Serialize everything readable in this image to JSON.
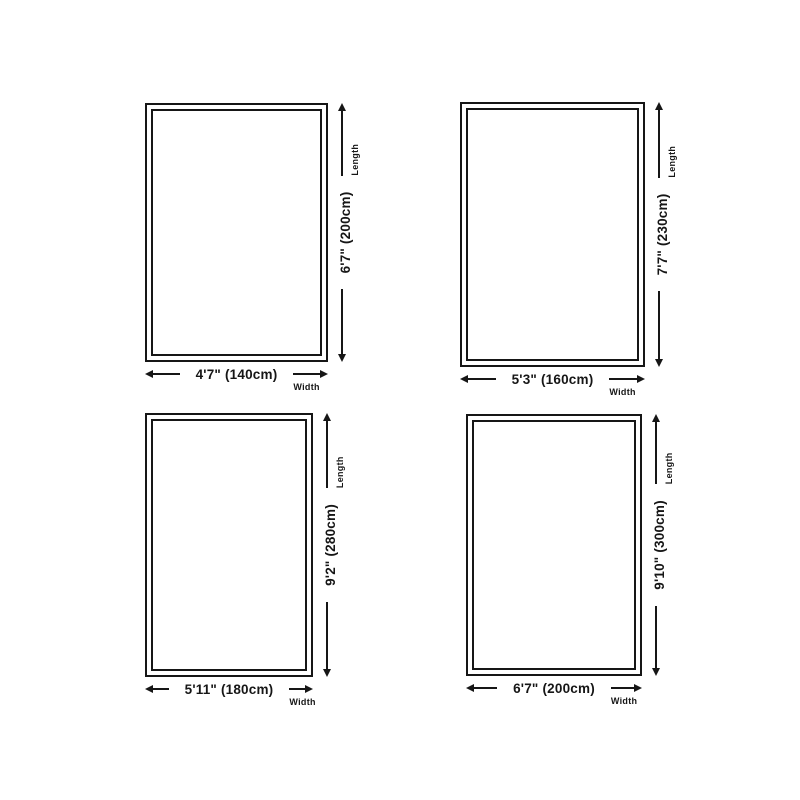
{
  "colors": {
    "ink": "#161616",
    "background": "#ffffff"
  },
  "axis_labels": {
    "width": "Width",
    "length": "Length"
  },
  "rugs": [
    {
      "width_label": "4'7\" (140cm)",
      "length_label": "6'7\" (200cm)",
      "width_imperial": "4'7\"",
      "length_imperial": "6'7\"",
      "width_cm": 140,
      "length_cm": 200
    },
    {
      "width_label": "5'3\" (160cm)",
      "length_label": "7'7\" (230cm)",
      "width_imperial": "5'3\"",
      "length_imperial": "7'7\"",
      "width_cm": 160,
      "length_cm": 230
    },
    {
      "width_label": "5'11\" (180cm)",
      "length_label": "9'2\" (280cm)",
      "width_imperial": "5'11\"",
      "length_imperial": "9'2\"",
      "width_cm": 180,
      "length_cm": 280
    },
    {
      "width_label": "6'7\" (200cm)",
      "length_label": "9'10\" (300cm)",
      "width_imperial": "6'7\"",
      "length_imperial": "9'10\"",
      "width_cm": 200,
      "length_cm": 300
    }
  ]
}
